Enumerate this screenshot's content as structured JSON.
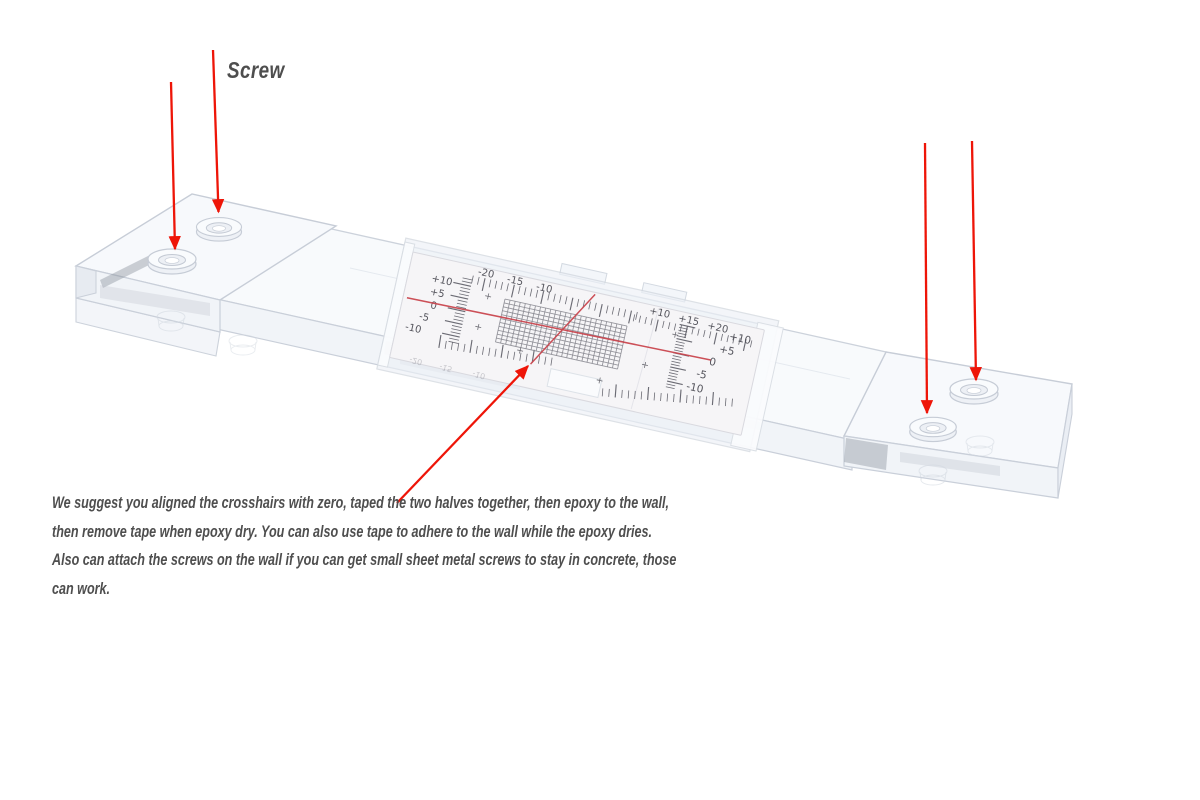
{
  "background": "#ffffff",
  "annotations": {
    "screw_label": "Screw",
    "instruction_lines": [
      "We suggest you aligned the crosshairs with zero, taped the two halves together, then epoxy to the wall,",
      "then remove tape when epoxy dry. You can also use tape to adhere to the wall while the epoxy dries.",
      "Also can attach the screws on the wall if you can get small sheet metal screws to stay in concrete, those",
      "can work."
    ],
    "arrow_color": "#ee1508",
    "text_color": "#4e4e4e"
  },
  "gauge": {
    "top_left_scale": [
      "-20",
      "-15",
      "-10"
    ],
    "top_right_scale": [
      "+10",
      "+15",
      "+20"
    ],
    "left_scale": [
      "+10",
      "+5",
      "0",
      "-5",
      "-10"
    ],
    "right_scale": [
      "+10",
      "+5",
      "0",
      "-5",
      "-10"
    ],
    "reflected_scale": [
      "-20",
      "-15",
      "-10"
    ],
    "plus_mark": "+",
    "crosshair_color": "#c9464e",
    "grid_color": "#87878f",
    "scale_text_color": "#55555d"
  }
}
